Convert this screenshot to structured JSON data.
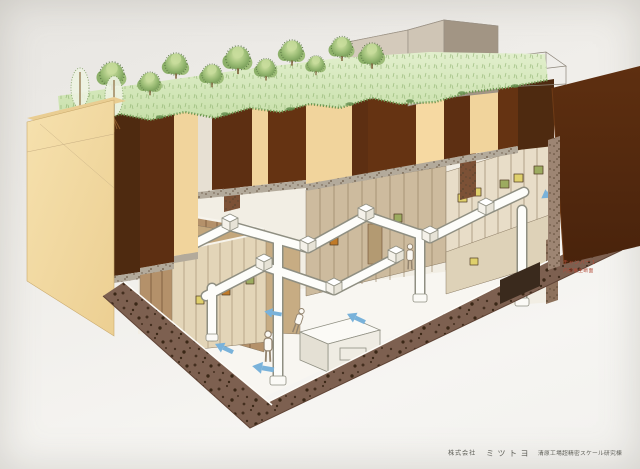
{
  "illustration": {
    "caption": {
      "company_prefix": "株式会社",
      "company_name": "ミツトヨ",
      "facility_name": "清原工場超精密スケール研究棟"
    },
    "annotation": {
      "line1": "チャンバー１",
      "line2": "内部養生断面"
    },
    "palette": {
      "paper": "#f2f1ee",
      "grass_green": "#cfe4b2",
      "tree_green": "#7ea55d",
      "earth_dark_brown": "#5d2f12",
      "earth_tan": "#f1d49c",
      "left_cut_face_tan": "#f3dca6",
      "concrete_speckled_brown": "#7d6050",
      "interior_wall_brown": "#b4916a",
      "interior_wall_beige": "#cdbb9e",
      "interior_wall_cream": "#e8ddc8",
      "duct_white": "#fdfdfa",
      "airflow_arrow_blue": "#79b2da",
      "building_gray": "#cfc5b5",
      "accent_yellow": "#dfd06c",
      "accent_orange": "#c07a28",
      "accent_green": "#9cab60",
      "annotation_red": "#b24a38",
      "caption_gray": "#5f5f58"
    }
  }
}
